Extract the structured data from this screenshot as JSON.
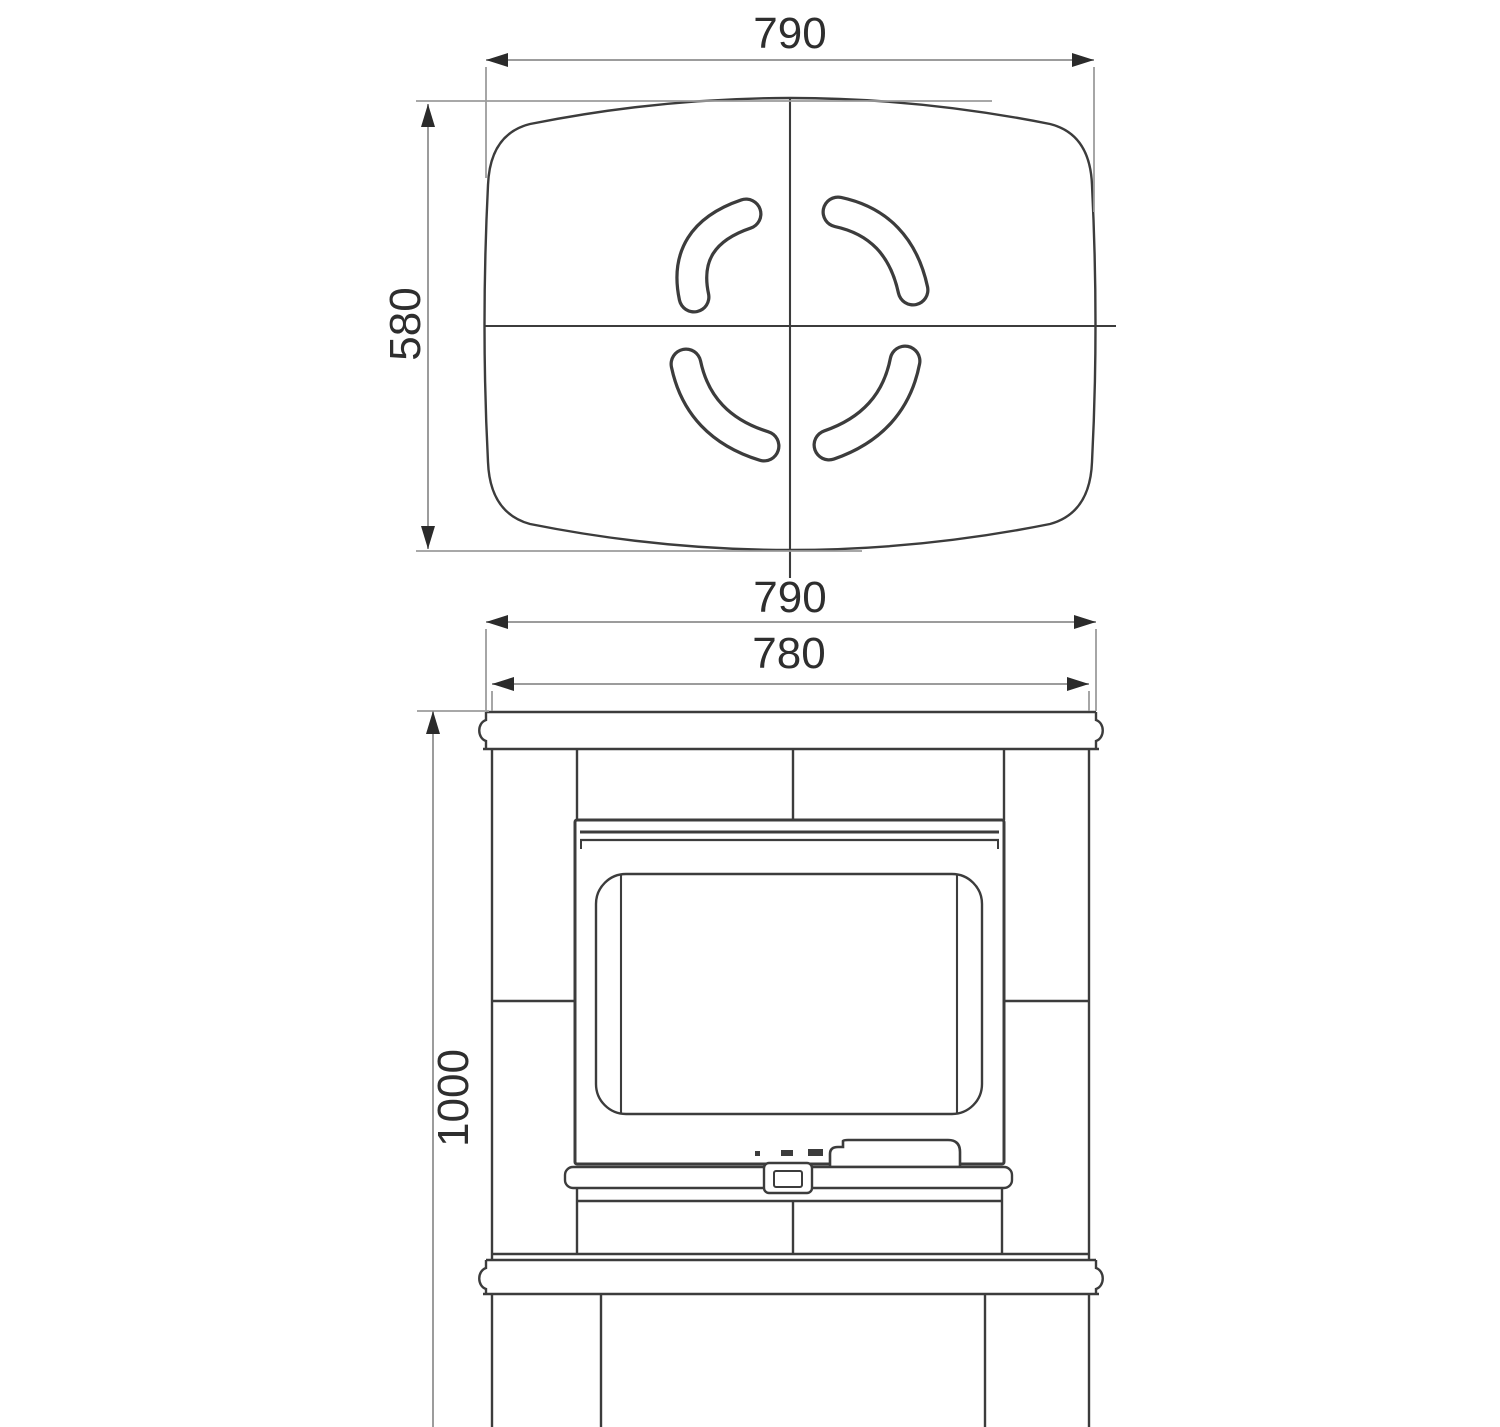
{
  "drawing": {
    "top_view": {
      "width_label": "790",
      "depth_label": "580"
    },
    "front_view": {
      "width_label": "790",
      "body_width_label": "780",
      "height_label": "1000"
    }
  },
  "colors": {
    "background": "#ffffff",
    "geometry_line": "#3c3c3c",
    "dimension_line": "#9c9c9c",
    "arrow": "#2b2b2b",
    "label_text": "#2e2e2e"
  }
}
